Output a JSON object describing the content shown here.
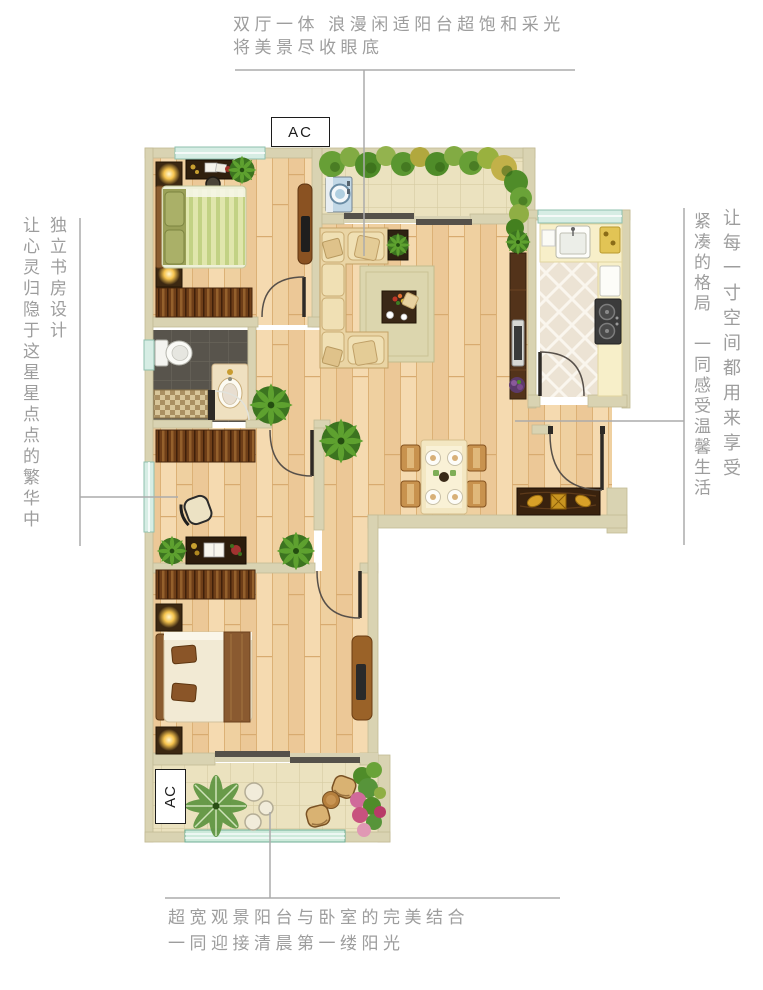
{
  "callouts": {
    "top": {
      "line1": "双厅一体 浪漫闲适阳台超饱和采光",
      "line2": "将美景尽收眼底"
    },
    "left": {
      "col_a": "独立书房设计",
      "col_b": "让心灵归隐于这星星点点的繁华中"
    },
    "right": {
      "col_a": "让每一寸空间都用来享受",
      "col_b": "紧凑的格局　一同感受温馨生活"
    },
    "bottom": {
      "line1": "超宽观景阳台与卧室的完美结合",
      "line2": "一同迎接清晨第一缕阳光"
    }
  },
  "labels": {
    "ac_top": "AC",
    "ac_bottom": "AC"
  },
  "colors": {
    "text": "#9d9d9d",
    "leader_line": "#ababab",
    "wall": "#d9d3b2",
    "wood_floor": "#f1d2a2",
    "balcony_tile": "#ebe2bf",
    "kitchen_tile": "#ece3d4",
    "bath_tile": "#58544c",
    "window": "#d6ede4",
    "sofa": "#ead5a5",
    "dark_wood": "#6e3e18",
    "plant": "#4f8c29"
  }
}
